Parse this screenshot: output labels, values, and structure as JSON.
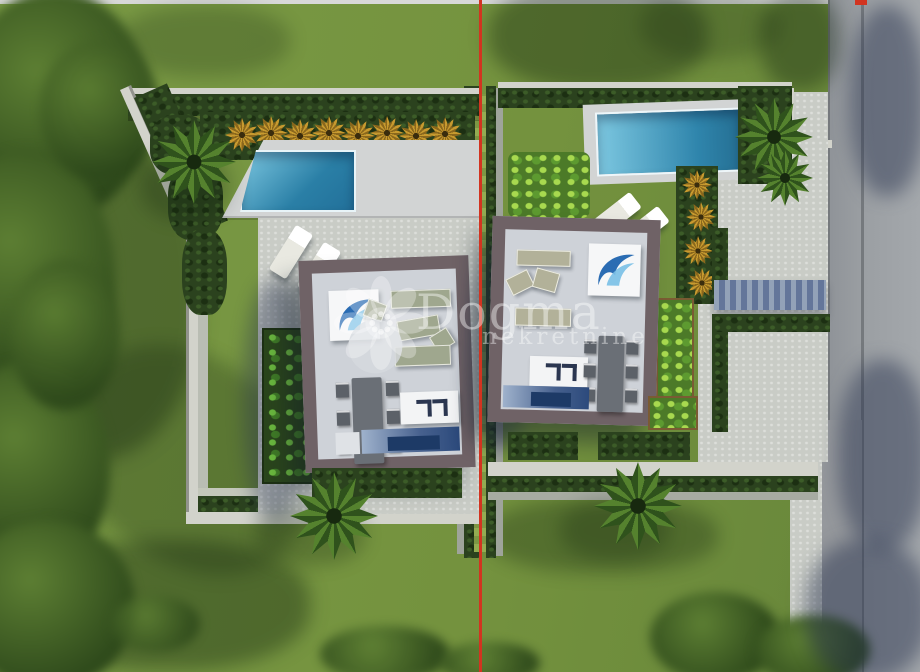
{
  "watermark": {
    "brand": "Dogma",
    "subtitle": "nekretnine"
  },
  "colors": {
    "grass": "#74923e",
    "hedge-dark": "#2b421e",
    "hedge-light": "#93ac52",
    "boundary-red": "#d23420",
    "road-gray": "#9b9fa3",
    "gravel": "#c9ccc6",
    "deck": "#d2d4d4",
    "pool-light": "#7cc7e0",
    "pool-dark": "#22709a",
    "wall-concrete": "#d2d3cb",
    "house-border": "#6f6266",
    "house-floor": "#ced2d8",
    "sofa-green": "#9fa78e",
    "sofa-beige": "#b2b199",
    "indoor-water": "#2c4a7c",
    "wave-blue": "#2a6cb3",
    "gold-palm": "#c79a2f",
    "watermark-white": "#ffffff"
  },
  "scene": {
    "type": "aerial-architectural-render",
    "description": "Top-down 3D visualization of two modern villas on adjacent parcels divided by a red property boundary line, with a road on the right",
    "left_parcel": {
      "objects": [
        "perimeter-hedge-wall",
        "swimming-pool",
        "pool-deck",
        "golden-palms-row",
        "palm-tree",
        "two-sun-loungers",
        "villa-roof-terrace",
        "dining-table-six-chairs",
        "wave-logo-panel",
        "vertical-garden",
        "palm-tree-south",
        "lawn"
      ]
    },
    "right_parcel": {
      "objects": [
        "perimeter-hedge-wall",
        "swimming-pool",
        "pool-deck",
        "palm-cluster",
        "golden-palms-column",
        "two-sun-loungers",
        "villa-roof-terrace",
        "dining-table-six-chairs",
        "wave-logo-panel",
        "pergola-walkway",
        "gravel-driveway",
        "planter-boxes",
        "palm-tree-south",
        "lawn"
      ]
    },
    "boundary": {
      "marker": "red-line",
      "hedge": "double-hedge-strip"
    },
    "road": {
      "position": "right-edge",
      "features": [
        "curb-channel",
        "tree-shadows"
      ]
    }
  }
}
